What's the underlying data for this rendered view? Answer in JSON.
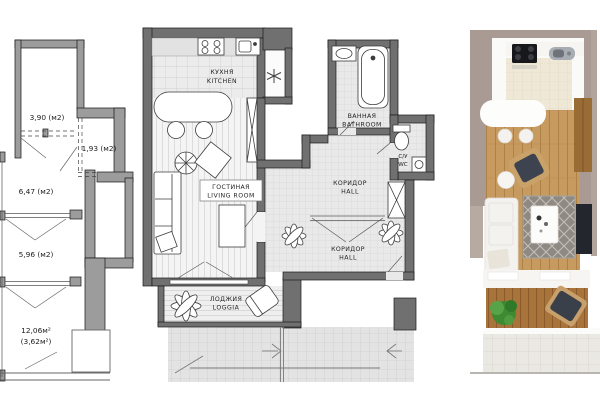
{
  "image": {
    "background": "#ffffff",
    "description": "Apartment floor plans: schematic area plan, detailed furnished plan, 3D render"
  },
  "left_plan": {
    "areas": [
      {
        "label": "3,90 (м2)"
      },
      {
        "label": "1,93 (м2)"
      },
      {
        "label": "6,47 (м2)"
      },
      {
        "label": "5,96 (м2)"
      },
      {
        "label": "12,06м²"
      },
      {
        "label": "(3,62м²)"
      }
    ]
  },
  "middle_plan": {
    "kitchen": {
      "ru": "КУХНЯ",
      "en": "KITCHEN"
    },
    "living": {
      "ru": "ГОСТИНАЯ",
      "en": "LIVING ROOM"
    },
    "bathroom": {
      "ru": "ВАННАЯ",
      "en": "BATHROOM"
    },
    "wc": {
      "ru": "С/У",
      "en": "WC"
    },
    "hall_upper": {
      "ru": "КОРИДОР",
      "en": "HALL"
    },
    "hall_lower": {
      "ru": "КОРИДОР",
      "en": "HALL"
    },
    "loggia": {
      "ru": "ЛОДЖИЯ",
      "en": "LOGGIA"
    }
  },
  "colors": {
    "left_plan_wall": "#9c9c9c",
    "middle_plan_wall": "#707070",
    "render_wall_taupe": "#a99b93",
    "wood_floor": "#c79a60",
    "loggia_wood": "#a8743b",
    "plant_green": "#3d8a33",
    "rug_gray": "#8f8984"
  }
}
